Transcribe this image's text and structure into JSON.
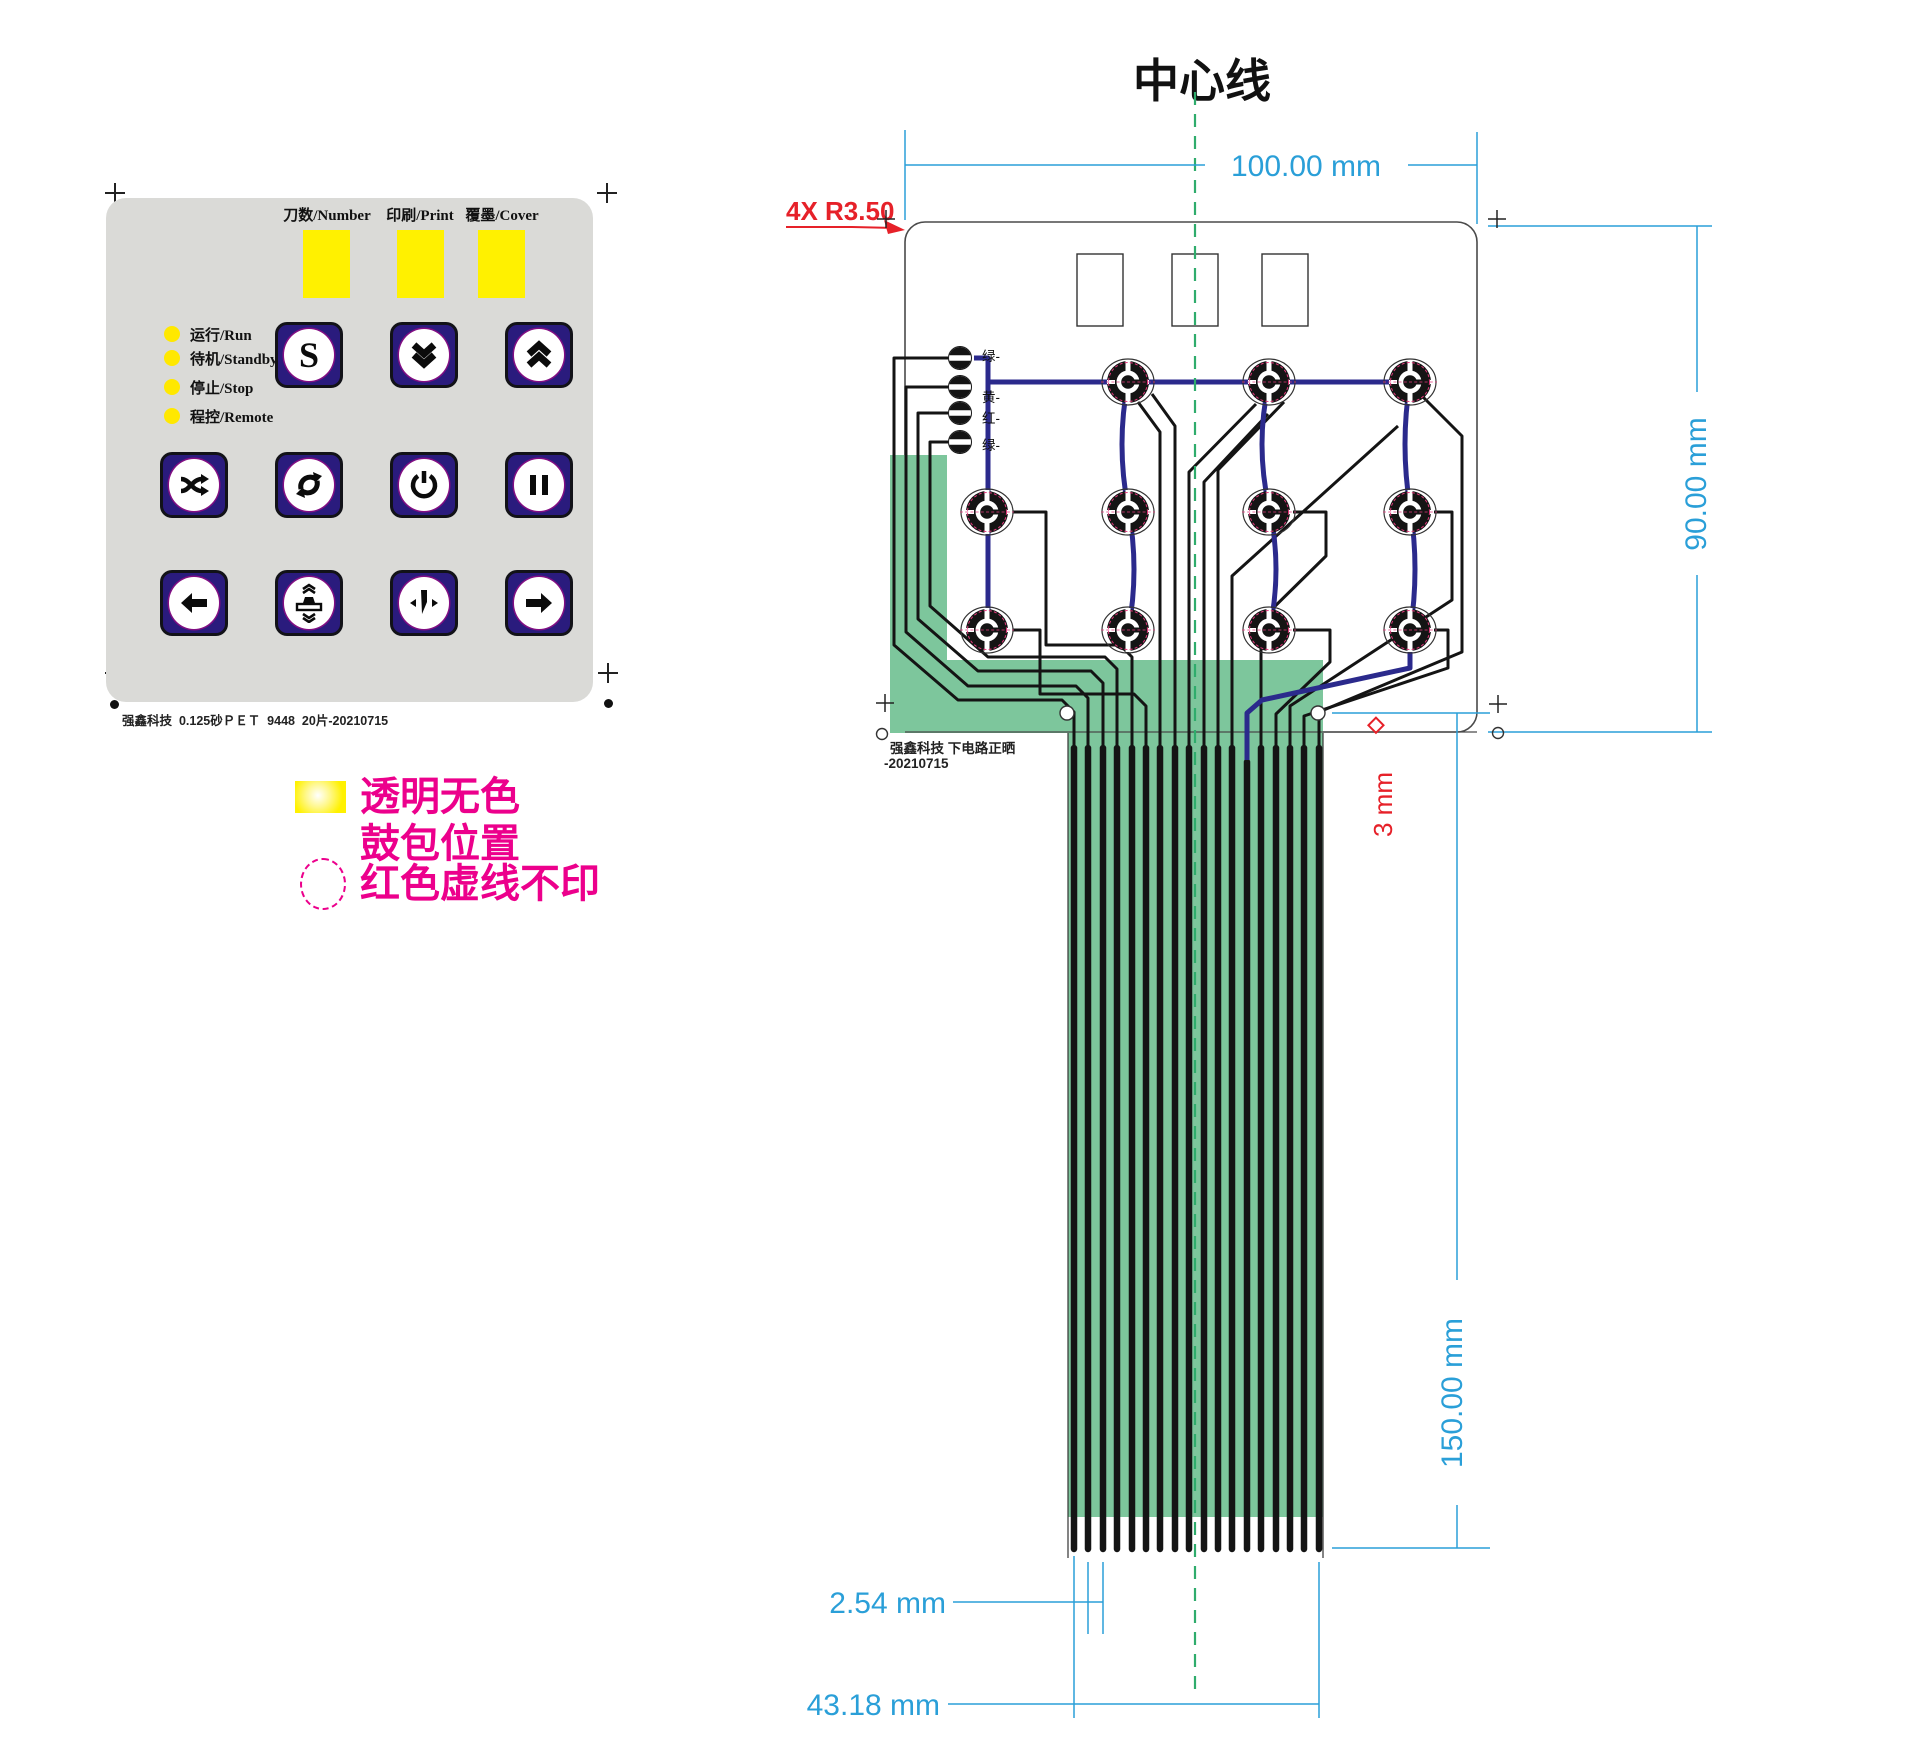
{
  "title": "中心线",
  "overlay": {
    "windows": [
      {
        "label": "刀数/Number"
      },
      {
        "label": "印刷/Print"
      },
      {
        "label": "覆墨/Cover"
      }
    ],
    "status_leds": [
      {
        "label": "运行/Run"
      },
      {
        "label": "待机/Standby"
      },
      {
        "label": "停止/Stop"
      },
      {
        "label": "程控/Remote"
      }
    ],
    "buttons": [
      {
        "name": "start",
        "glyph": "S"
      },
      {
        "name": "page-down"
      },
      {
        "name": "page-up"
      },
      {
        "name": "shuffle"
      },
      {
        "name": "cycle"
      },
      {
        "name": "power"
      },
      {
        "name": "pause"
      },
      {
        "name": "arrow-left"
      },
      {
        "name": "press-platen"
      },
      {
        "name": "blade"
      },
      {
        "name": "arrow-right"
      }
    ],
    "footer": "强鑫科技  0.125砂ＰＥＴ  9448  20片-20210715"
  },
  "legend": {
    "line1": "透明无色",
    "line2": "鼓包位置",
    "line3": "红色虚线不印"
  },
  "circuit": {
    "led_labels": [
      "绿-",
      "黄-",
      "红-",
      "绿-"
    ],
    "note_line1": "强鑫科技  下电路正晒",
    "note_line2": "-20210715",
    "dims": {
      "width": "100.00 mm",
      "height": "90.00 mm",
      "tail_length": "150.00 mm",
      "pitch": "2.54 mm",
      "tail_width": "43.18 mm",
      "corner_radius": "4X R3.50",
      "hole_diameter_symbol": "◇",
      "hole_diameter": "3 mm"
    }
  },
  "colors": {
    "button_navy": "#2a1b7d",
    "window_yellow": "#fff100",
    "panel_gray": "#dadad7",
    "legend_magenta": "#ec008c",
    "dimension_blue": "#2a9fd8",
    "annotation_red": "#e62129",
    "flex_green": "#7dc69c",
    "centerline_green": "#2fac6c",
    "trace_blue": "#2b2a8c",
    "trace_black": "#141414"
  }
}
